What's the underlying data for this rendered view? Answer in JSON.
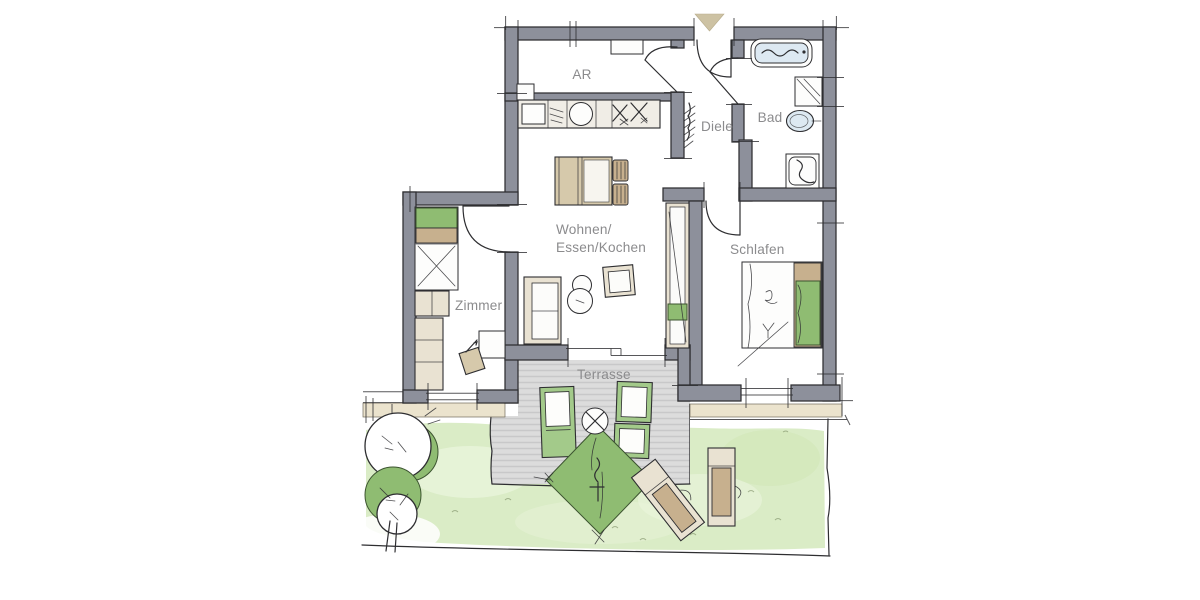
{
  "page": {
    "background": "#ffffff",
    "kind": "apartment-floor-plan-drawing"
  },
  "colors": {
    "wall": "#8d909b",
    "line": "#2e2e31",
    "text": "#8b8b8d",
    "beige": "#d6c9ab",
    "beige_dark": "#c7b08e",
    "beige_light": "#e9e2d2",
    "white": "#fdfdfc",
    "green": "#8fbc72",
    "green_frame": "#a3ca8a",
    "lawn": "#daecc6",
    "lawn_light": "#eaf5dc",
    "terrace": "#dcdcdc",
    "terrace_stripe": "#c8c8c9",
    "strip": "#eae2cb",
    "fixture": "#dde9f2",
    "marker": "#cdc2a3"
  },
  "rooms": [
    {
      "id": "ar",
      "label": "AR"
    },
    {
      "id": "diele",
      "label": "Diele"
    },
    {
      "id": "bad",
      "label": "Bad"
    },
    {
      "id": "wohnen",
      "label_line1": "Wohnen/",
      "label_line2": "Essen/Kochen"
    },
    {
      "id": "zimmer",
      "label": "Zimmer"
    },
    {
      "id": "schlafen",
      "label": "Schlafen"
    },
    {
      "id": "terrasse",
      "label": "Terrasse"
    }
  ],
  "icons": {
    "entrance-arrow-icon": "▼",
    "door-swing-icon": "quarter-arc",
    "window-icon": "double-line",
    "bathtub-icon": "rounded-rect",
    "shower-icon": "square-with-s-curve",
    "washbasin-icon": "oval",
    "washing-machine-icon": "square-with-diagonal",
    "kitchen-sink-icon": "circle",
    "cooktop-icon": "x-marks",
    "coat-rack-icon": "hatched-wavy-line",
    "parasol-icon": "diamond",
    "tree-icon": "overlapping-circles",
    "sun-lounger-icon": "rect",
    "garden-chair-icon": "green-framed-rect"
  }
}
